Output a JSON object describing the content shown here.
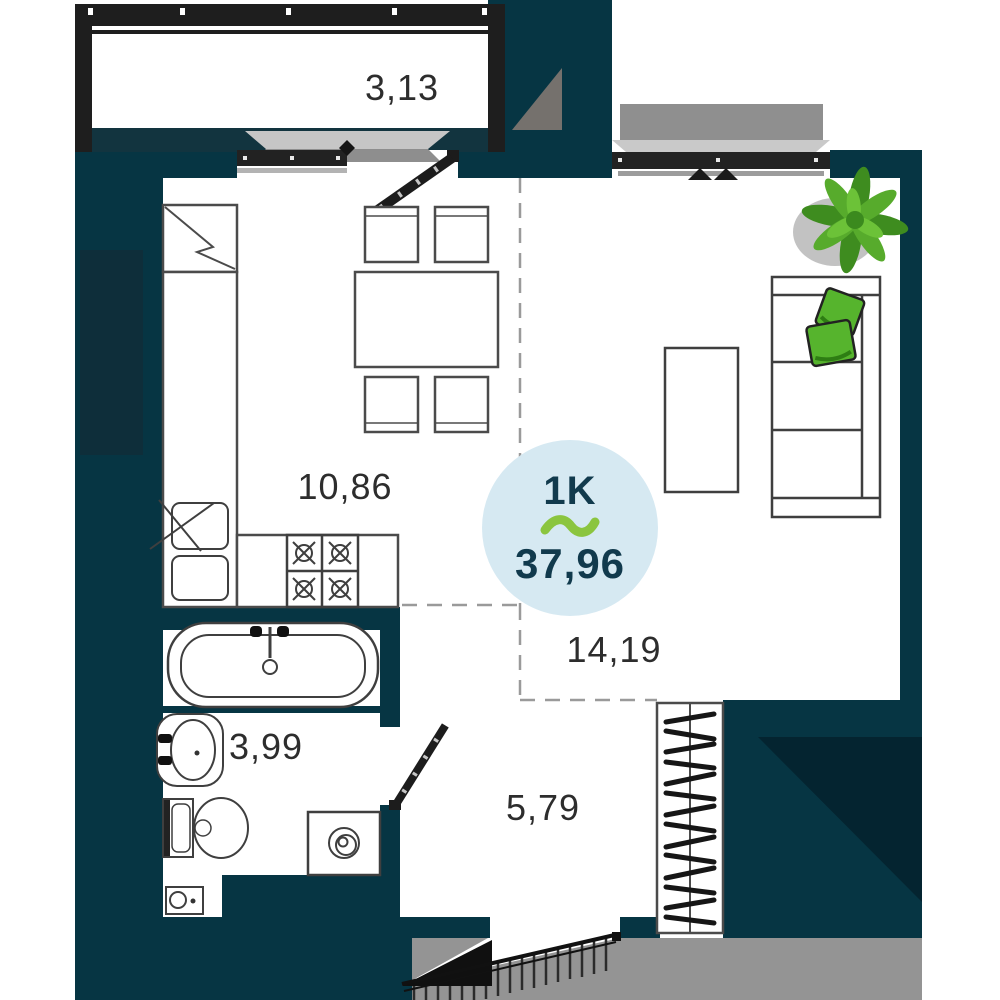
{
  "plan_card": {
    "badge": {
      "unit_type": "1K",
      "area_value": "37,96"
    },
    "rooms": [
      {
        "name": "balcony",
        "area_label": "3,13"
      },
      {
        "name": "kitchen-dining",
        "area_label": "10,86"
      },
      {
        "name": "living-room",
        "area_label": "14,19"
      },
      {
        "name": "bathroom",
        "area_label": "3,99"
      },
      {
        "name": "hallway",
        "area_label": "5,79"
      }
    ],
    "colors": {
      "wall": "#063543",
      "wall_shadow": "#042430",
      "balcony_frame": "#1e1e1e",
      "exterior_gray": "#949494",
      "sill_light": "#c9c9c9",
      "sill_mid": "#8e8e8e",
      "badge_bg": "#d6e9f2",
      "badge_text": "#113a4d",
      "accent_green": "#8bc53f",
      "plant_green": "#57ab2c",
      "pillow_green": "#56b42d",
      "label_text": "#2d2d2d"
    }
  }
}
